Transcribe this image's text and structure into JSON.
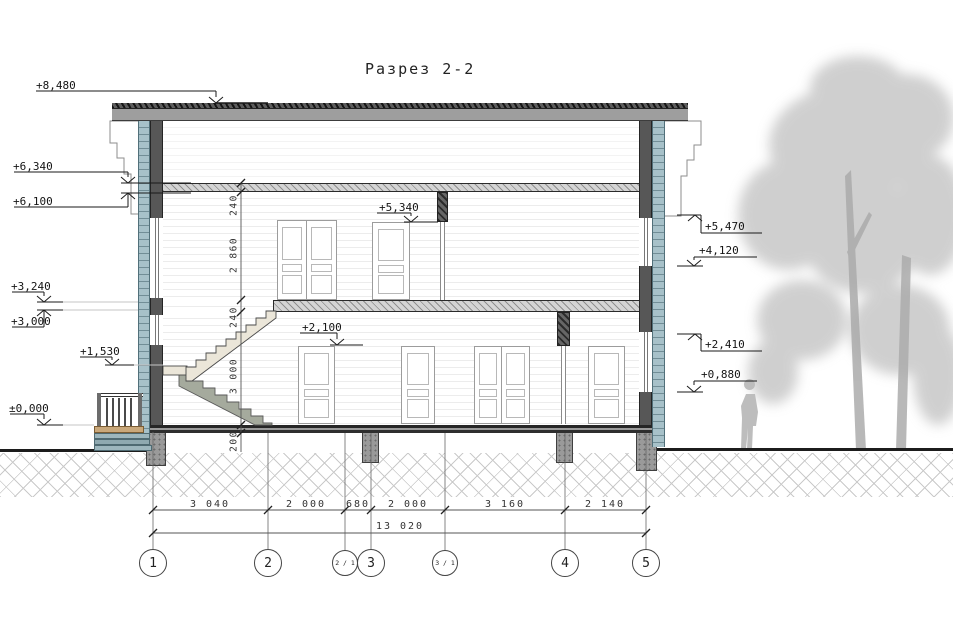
{
  "title": "Разрез 2-2",
  "markers": {
    "left": [
      "+8,480",
      "+6,340",
      "+6,100",
      "+3,240",
      "+3,000",
      "+1,530",
      "±0,000"
    ],
    "right": [
      "+5,470",
      "+4,120",
      "+2,410",
      "+0,880"
    ],
    "interior": [
      "+5,340",
      "+2,100"
    ]
  },
  "dimensions": {
    "vertical": [
      "240",
      "2 860",
      "240",
      "3 000",
      "200"
    ],
    "horizontal": [
      "3 040",
      "2 000",
      "680",
      "2 000",
      "3 160",
      "2 140"
    ],
    "total": "13 020"
  },
  "axes": [
    "1",
    "2",
    "2 / 1",
    "3",
    "3 / 1",
    "4",
    "5"
  ],
  "colors": {
    "cladding": "#a7c1c9",
    "roof": "#9e9e9e",
    "structure": "#575757",
    "stair_flight": "#a5aa9d",
    "porch_deck": "#c9a87b",
    "vegetation": "#b5b5b5"
  }
}
